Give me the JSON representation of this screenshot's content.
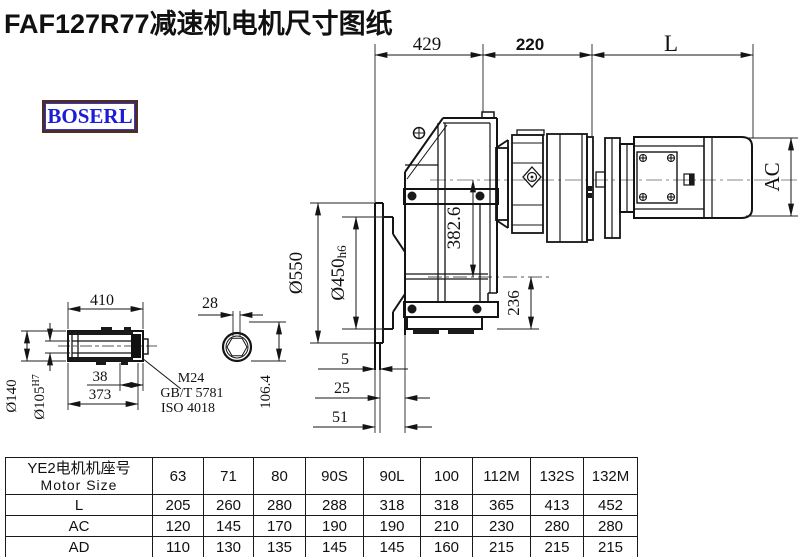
{
  "title": "FAF127R77减速机电机尺寸图纸",
  "logo": {
    "text": "BOSERL"
  },
  "colors": {
    "logo_text": "#1c1cd8",
    "logo_border": "#4d2d26",
    "line": "#141414"
  },
  "drawing": {
    "dims": {
      "len429": "429",
      "len220": "220",
      "lenL": "L",
      "ac": "AC",
      "dia550": "Ø550",
      "dia450": "Ø450",
      "dia450sub": "h6",
      "h382": "382.6",
      "h236": "236",
      "off5": "5",
      "off25": "25",
      "off51": "51",
      "shaft410": "410",
      "shaft38": "38",
      "shaft373": "373",
      "dia140": "Ø140",
      "dia105": "Ø105",
      "dia105sup": "H7",
      "key28": "28",
      "key106": "106.4"
    },
    "notes": {
      "thread": "M24",
      "std1": "GB/T 5781",
      "std2": "ISO 4018"
    }
  },
  "table": {
    "header_cn": "YE2电机机座号",
    "header_en": "Motor Size",
    "columns": [
      "63",
      "71",
      "80",
      "90S",
      "90L",
      "100",
      "112M",
      "132S",
      "132M"
    ],
    "rows": [
      {
        "label": "L",
        "values": [
          "205",
          "260",
          "280",
          "288",
          "318",
          "318",
          "365",
          "413",
          "452"
        ]
      },
      {
        "label": "AC",
        "values": [
          "120",
          "145",
          "170",
          "190",
          "190",
          "210",
          "230",
          "280",
          "280"
        ]
      },
      {
        "label": "AD",
        "values": [
          "110",
          "130",
          "135",
          "145",
          "145",
          "160",
          "215",
          "215",
          "215"
        ]
      }
    ]
  }
}
